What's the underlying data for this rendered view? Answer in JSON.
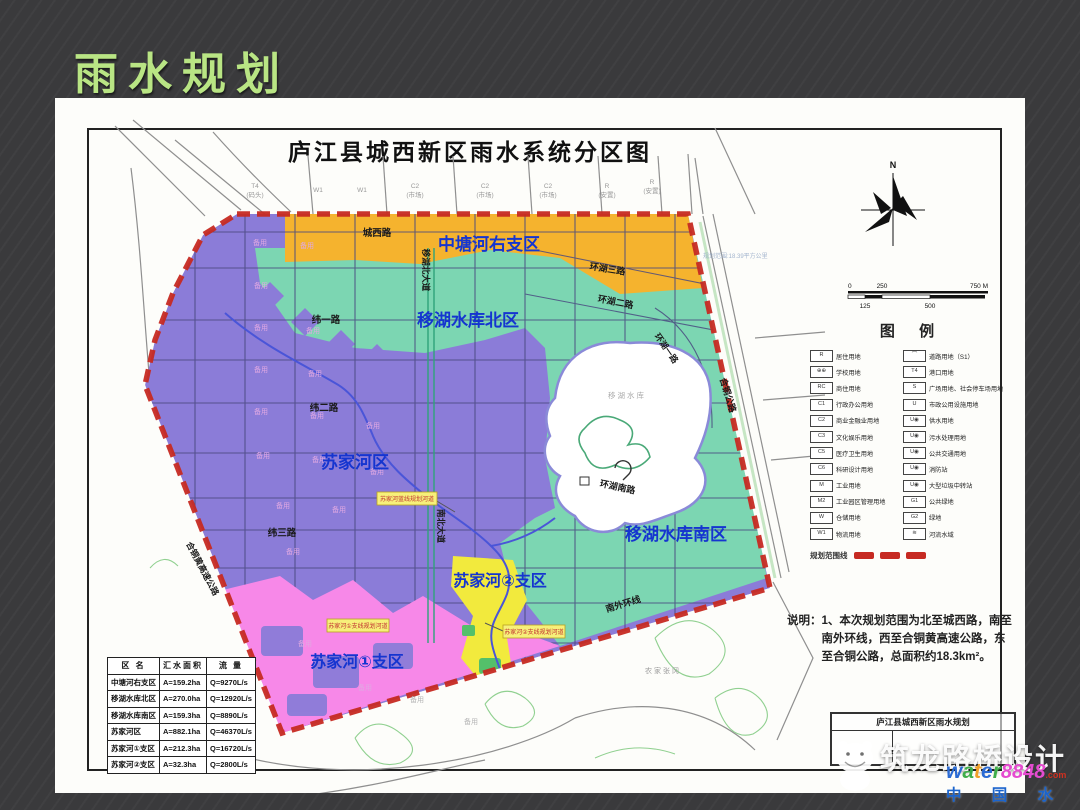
{
  "slide": {
    "title": "雨水规划"
  },
  "colors": {
    "title_green": "#b9e584",
    "purple": "#8b7cd8",
    "teal": "#7cd6b2",
    "orange": "#f5b32e",
    "pink": "#f788e8",
    "yellow": "#f2ea3d",
    "boundary_red": "#c62a22",
    "label_blue": "#1535d0"
  },
  "map": {
    "title": "庐江县城西新区雨水系统分区图",
    "zone_labels": {
      "zhongtang": "中塘河右支区",
      "yihu_north": "移湖水库北区",
      "sujiahe": "苏家河区",
      "yihu_south": "移湖水库南区",
      "sujiahe1": "苏家河①支区",
      "sujiahe2": "苏家河②支区"
    },
    "road_labels": {
      "chengxi": "城西路",
      "huanhu3": "环湖三路",
      "huanhu2": "环湖二路",
      "huanhu1": "环湖一路",
      "wei1": "纬一路",
      "wei2": "纬二路",
      "wei3": "纬三路",
      "yihubei_ave": "移湖北大道",
      "nanbei_ave": "南北大道",
      "huanhunan": "环湖南路",
      "nanwai": "南外环线",
      "hetong": "合铜公路",
      "hetonghuang": "合铜黄高速公路"
    },
    "lake_label": "移湖水库",
    "reserved_label": "备用",
    "village_label": "农家张冈",
    "range_note": "规划范围:18.39平方公里",
    "compass_n": "N",
    "callouts": {
      "blue_line": "苏家河蓝线规划河道",
      "branch1": "苏家河①支线规划河道",
      "branch2": "苏家河②支线规划河道"
    },
    "outside_labels": [
      {
        "code": "T4",
        "sub": "(码头)"
      },
      {
        "code": "W1",
        "sub": ""
      },
      {
        "code": "W1",
        "sub": ""
      },
      {
        "code": "C2",
        "sub": "(市场)"
      },
      {
        "code": "C2",
        "sub": "(市场)"
      },
      {
        "code": "C2",
        "sub": "(市场)"
      },
      {
        "code": "R",
        "sub": "(安置)"
      },
      {
        "code": "R",
        "sub": "(安置)"
      }
    ],
    "scalebar": {
      "top": [
        "0",
        "250",
        "750 M"
      ],
      "bottom": [
        "125",
        "500"
      ]
    }
  },
  "legend": {
    "title": "图  例",
    "left": [
      {
        "code": "R",
        "label": "居住用地"
      },
      {
        "code": "⊕⊕",
        "label": "学校用地"
      },
      {
        "code": "RC",
        "label": "商住用地"
      },
      {
        "code": "C1",
        "label": "行政办公用地"
      },
      {
        "code": "C2",
        "label": "商业金融业用地"
      },
      {
        "code": "C3",
        "label": "文化娱乐用地"
      },
      {
        "code": "C5",
        "label": "医疗卫生用地"
      },
      {
        "code": "C6",
        "label": "科研设计用地"
      },
      {
        "code": "M",
        "label": "工业用地"
      },
      {
        "code": "M2",
        "label": "工业园区管理用地"
      },
      {
        "code": "W",
        "label": "仓储用地"
      },
      {
        "code": "W1",
        "label": "物流用地"
      }
    ],
    "right": [
      {
        "code": "⌒",
        "label": "道路用地（S1）"
      },
      {
        "code": "T4",
        "label": "港口用地"
      },
      {
        "code": "S",
        "label": "广场用地、社会停车场用地"
      },
      {
        "code": "U",
        "label": "市政公用设施用地"
      },
      {
        "code": "U◉",
        "label": "供水用地"
      },
      {
        "code": "U◉",
        "label": "污水处理用地"
      },
      {
        "code": "U◉",
        "label": "公共交通用地"
      },
      {
        "code": "U◉",
        "label": "消防站"
      },
      {
        "code": "U◉",
        "label": "大型垃圾中转站"
      },
      {
        "code": "G1",
        "label": "公共绿地"
      },
      {
        "code": "G2",
        "label": "绿地"
      },
      {
        "code": "≋",
        "label": "河流水域"
      }
    ],
    "range_line_label": "规划范围线"
  },
  "note": {
    "label": "说明：",
    "text": "1、本次规划范围为北至城西路，南至南外环线，西至合铜黄高速公路，东至合铜公路，总面积约18.3km²。"
  },
  "titleblock": {
    "line1": "庐江县城西新区雨水规划"
  },
  "table": {
    "headers": [
      "区  名",
      "汇水面积",
      "流  量"
    ],
    "rows": [
      {
        "name": "中塘河右支区",
        "area": "A=159.2ha",
        "flow": "Q=9270L/s"
      },
      {
        "name": "移湖水库北区",
        "area": "A=270.0ha",
        "flow": "Q=12920L/s"
      },
      {
        "name": "移湖水库南区",
        "area": "A=159.3ha",
        "flow": "Q=8890L/s"
      },
      {
        "name": "苏家河区",
        "area": "A=882.1ha",
        "flow": "Q=46370L/s"
      },
      {
        "name": "苏家河①支区",
        "area": "A=212.3ha",
        "flow": "Q=16720L/s"
      },
      {
        "name": "苏家河②支区",
        "area": "A=32.3ha",
        "flow": "Q=2800L/s"
      }
    ]
  },
  "watermark": {
    "big": "筑龙路桥设计",
    "water_letters": [
      "w",
      "a",
      "t",
      "e",
      "r"
    ],
    "num": "8848",
    "dotcom": ".com",
    "cn": "中 国 水 业 网"
  }
}
